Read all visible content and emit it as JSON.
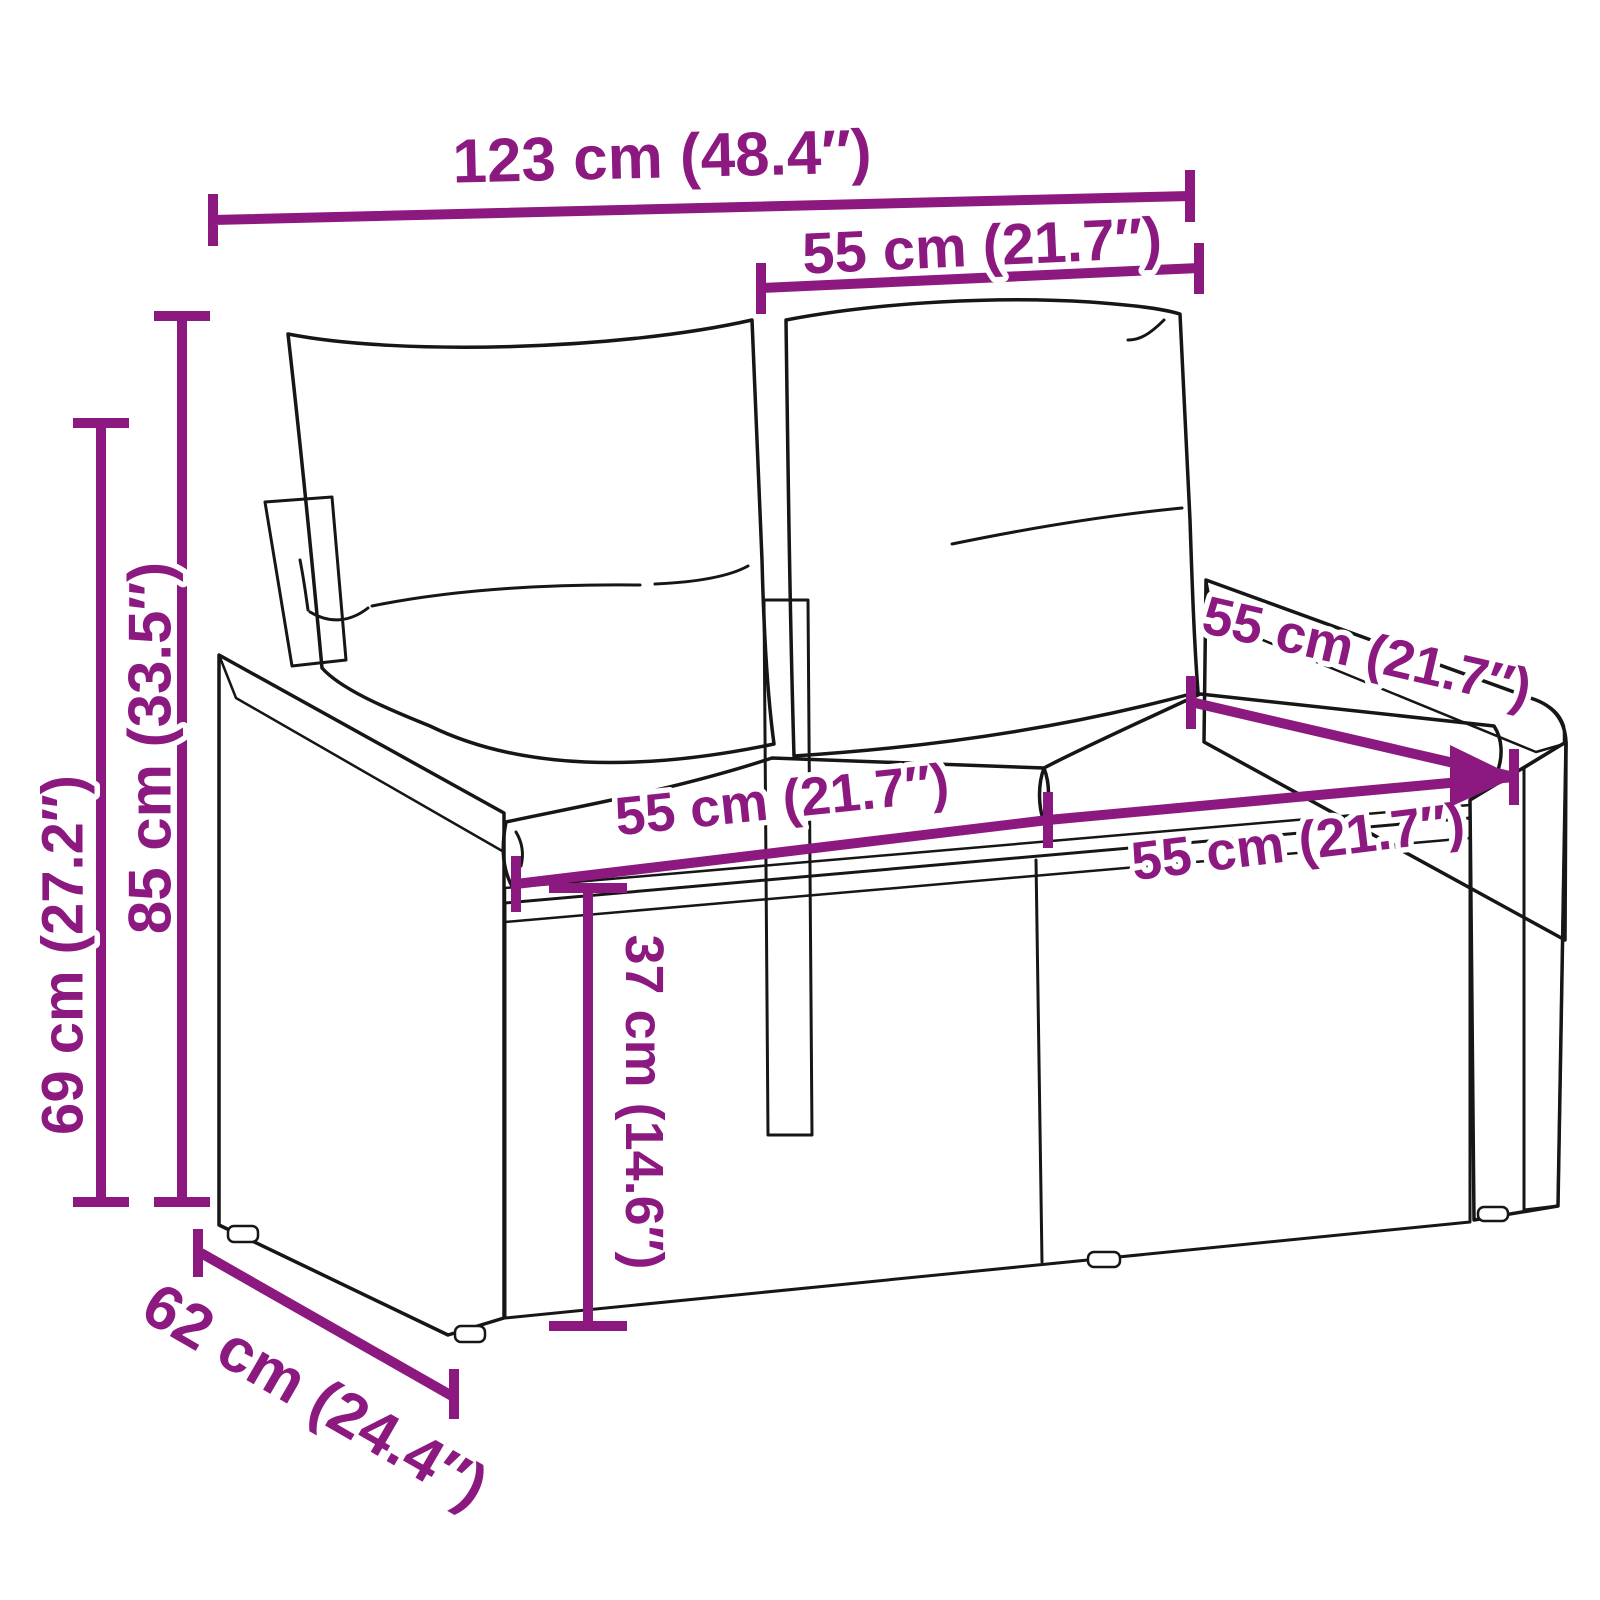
{
  "diagram": {
    "colors": {
      "dimension_accent": "#8C1980",
      "line_art": "#161616",
      "background": "#FFFFFF"
    },
    "dimensions": {
      "overall_width": "123 cm (48.4″)",
      "back_cushion_width": "55 cm (21.7″)",
      "total_height": "85 cm (33.5″)",
      "arm_height": "69 cm (27.2″)",
      "left_seat_width": "55 cm (21.7″)",
      "right_seat_width": "55 cm (21.7″)",
      "seat_depth": "55 cm (21.7″)",
      "base_height": "37 cm (14.6″)",
      "overall_depth": "62 cm (24.4″)"
    }
  }
}
